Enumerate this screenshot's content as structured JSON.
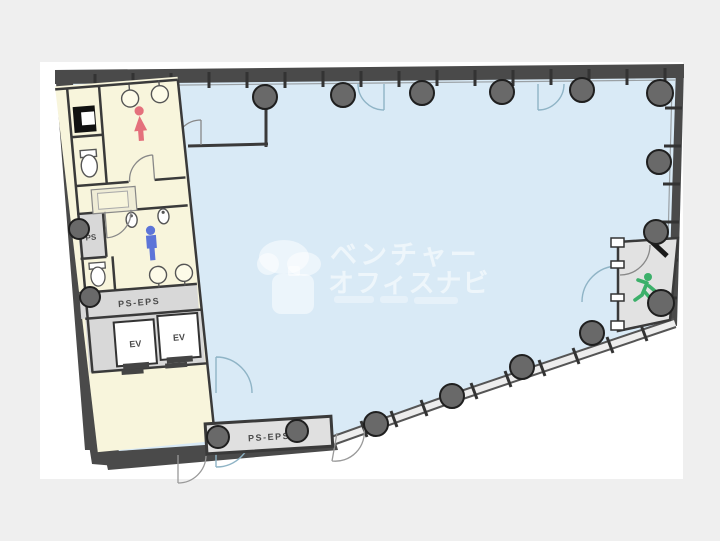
{
  "page": {
    "background_color": "#efefef",
    "canvas_color": "#ffffff"
  },
  "floor_plan": {
    "area_colors": {
      "open_space": "#d9eaf6",
      "service_rooms": "#f8f5dc",
      "shared_zones": "#d8d8d8",
      "stair_room": "#e2e2e2",
      "walls": "#4a4a4a",
      "columns": "#696969"
    },
    "labels": {
      "ps": "PS",
      "ps_eps_left": "PS-EPS",
      "ps_eps_bottom": "PS-EPS",
      "elevator_1": "EV",
      "elevator_2": "EV"
    },
    "icons": {
      "female": {
        "name": "female-person-icon",
        "color": "#e4707c"
      },
      "male": {
        "name": "male-person-icon",
        "color": "#5c74d8"
      },
      "exit": {
        "name": "running-person-icon",
        "color": "#3cb06a"
      }
    },
    "watermark": {
      "line1": "ベンチャー",
      "line2": "オフィスナビ"
    }
  }
}
